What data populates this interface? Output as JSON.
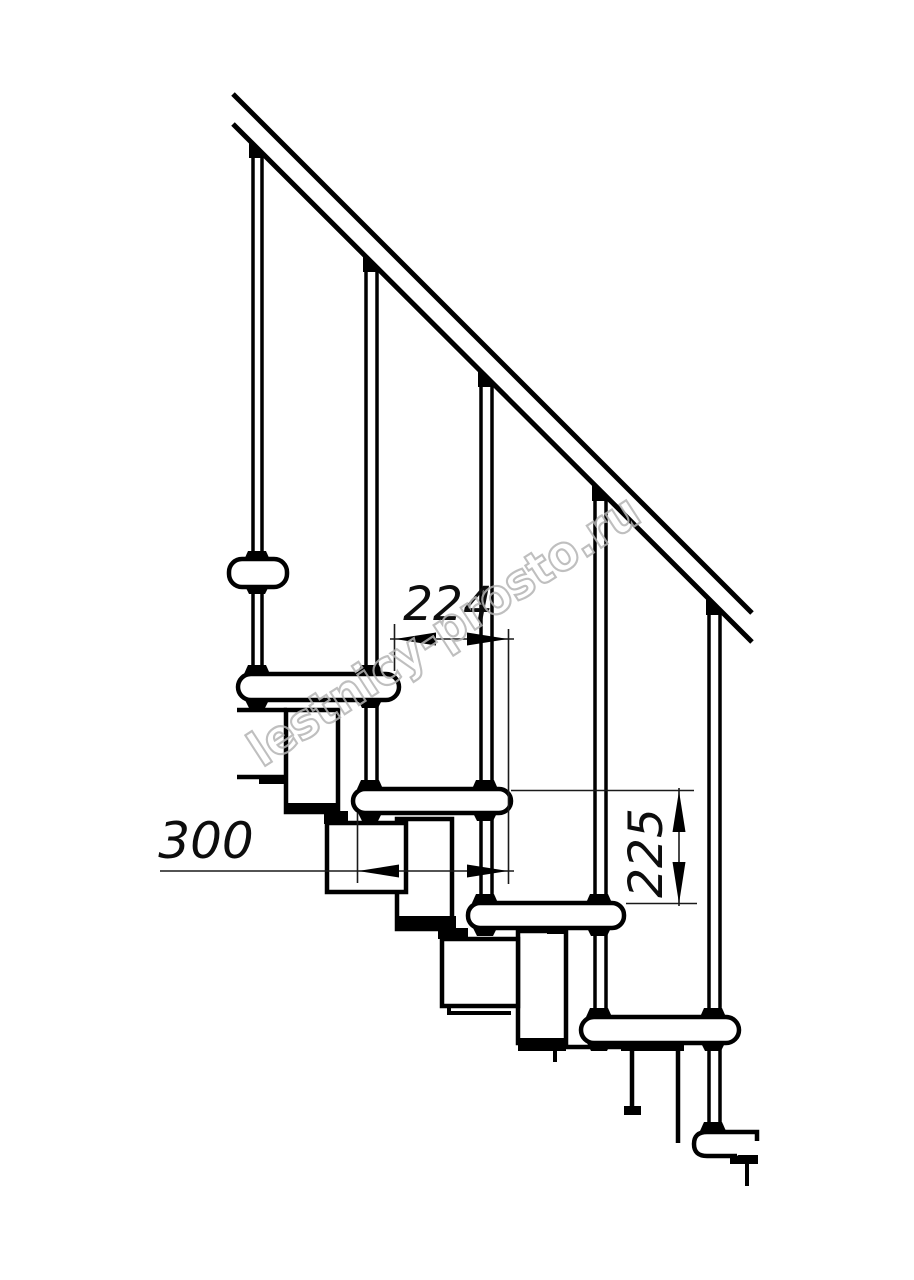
{
  "dimensions": {
    "tread_nose_spacing": "224",
    "tread_depth": "300",
    "step_rise": "225"
  },
  "watermark": {
    "text": "lestnicy-prosto.ru",
    "color": "#b4b4b4"
  },
  "colors": {
    "line": "#000000",
    "background": "#ffffff"
  }
}
